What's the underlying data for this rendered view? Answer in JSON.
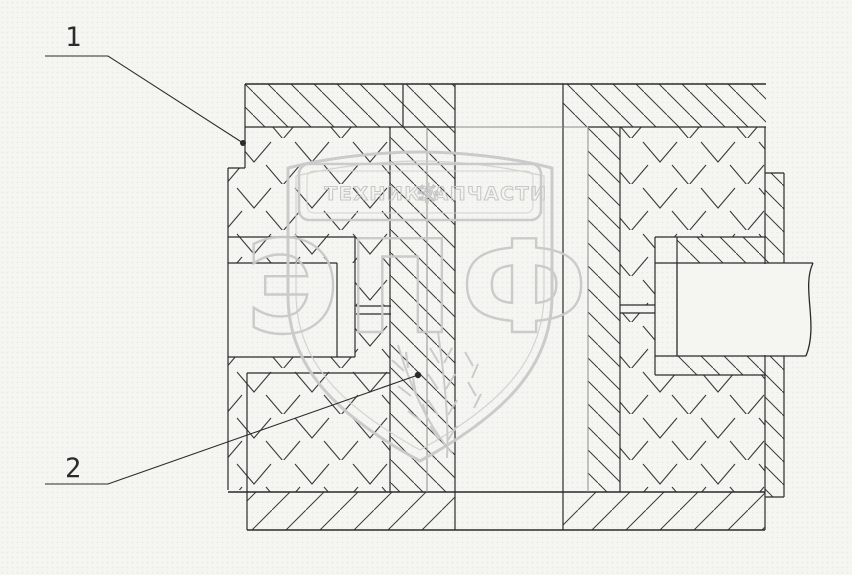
{
  "drawing": {
    "kind": "technical-section-drawing",
    "callouts": [
      {
        "label": "1"
      },
      {
        "label": "2"
      }
    ]
  },
  "watermark": {
    "word_left": "ТЕХНИКА",
    "word_right": "ЗАПЧАСТИ",
    "acronym": "ЭПФ",
    "gear_icon": "gear",
    "wheat_icon": "wheat-ears"
  },
  "colors": {
    "background": "#f5f5f1",
    "line": "#2b2b2b",
    "line_gray": "#8a8a8a",
    "hatch": "#3a3a3a",
    "watermark": "#c8c8c8"
  }
}
